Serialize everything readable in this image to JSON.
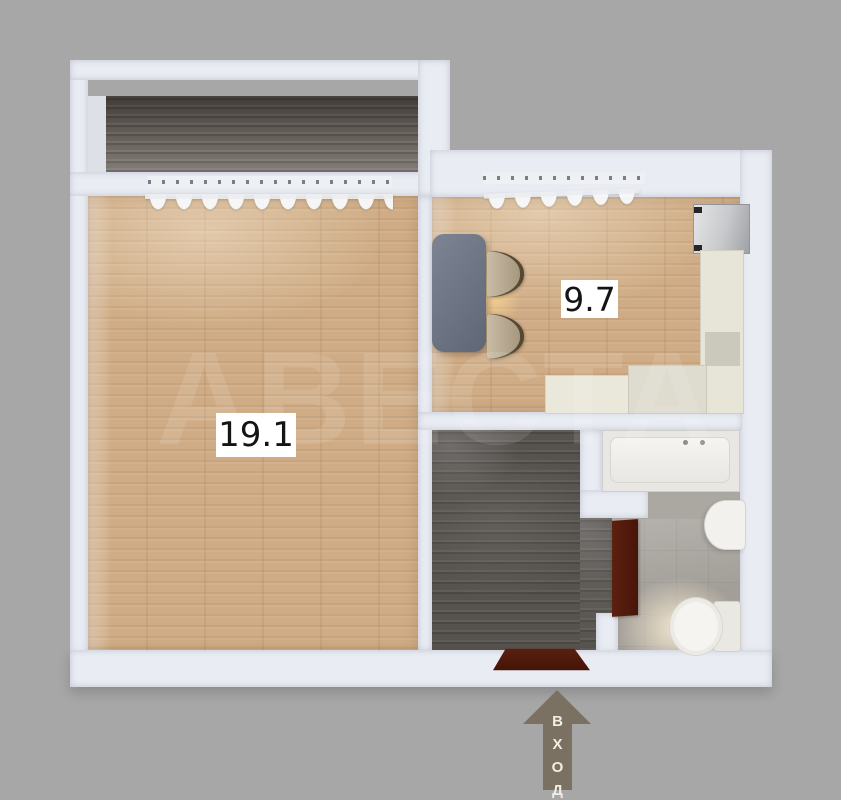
{
  "title": "apartment-floor-plan",
  "background_color": "#a7a7a7",
  "rooms": {
    "living_room": {
      "area_label": "19.1",
      "floor": "light wood"
    },
    "kitchen": {
      "area_label": "9.7",
      "floor": "light wood"
    },
    "balcony": {
      "floor": "dark wood"
    },
    "hallway": {
      "floor": "dark wood"
    },
    "bathroom": {
      "floor": "gray tile",
      "fixtures": [
        "bathtub",
        "sink",
        "toilet"
      ]
    }
  },
  "kitchen_furniture": [
    "dining-table",
    "chair",
    "chair",
    "fridge",
    "counter"
  ],
  "entrance": {
    "label": "ВХОД",
    "letters": [
      "В",
      "Х",
      "О",
      "Д"
    ],
    "arrow_color": "#7b7163"
  },
  "watermark": {
    "text": "АВЕСТА",
    "opacity": 0.1
  },
  "doors": {
    "color": "#521b0e"
  },
  "palette": {
    "wall": "#e9ecf3",
    "light_wood": "#cfac85",
    "dark_wood": "#5b5652",
    "tile": "#a8a49e",
    "counter": "#e7e4d8",
    "table": "#6b7280",
    "fixture_white": "#f2f1ed"
  }
}
